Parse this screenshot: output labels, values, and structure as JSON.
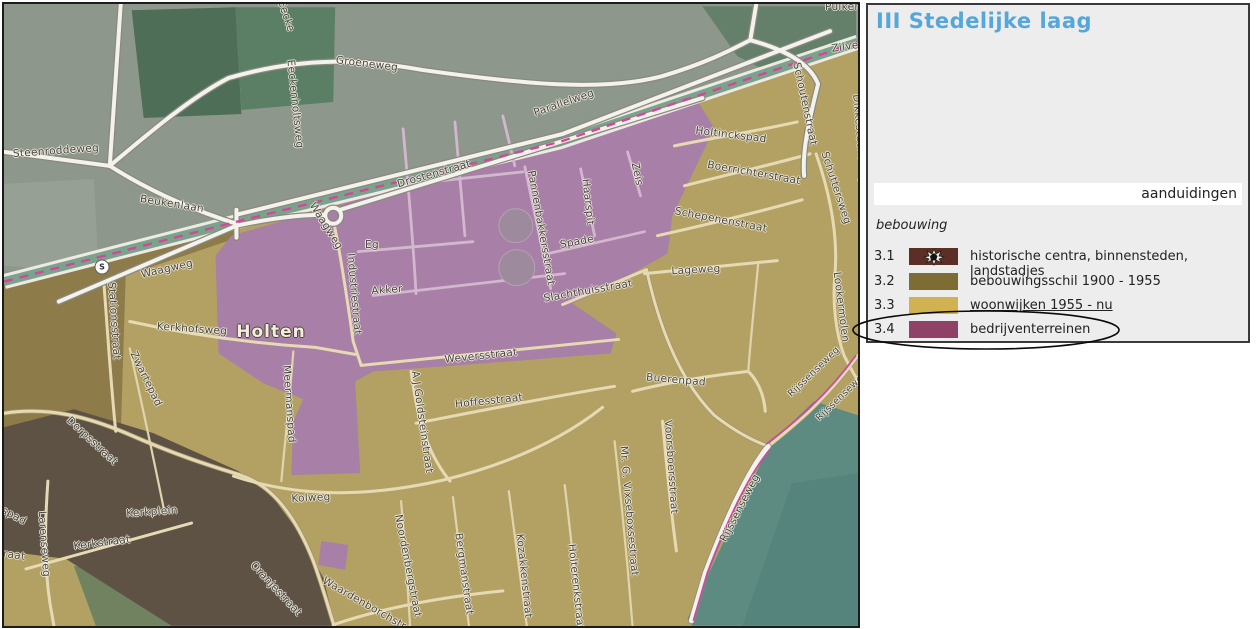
{
  "legend": {
    "title": "III Stedelijke laag",
    "tab": "aanduidingen",
    "section": "bebouwing",
    "rows": [
      {
        "code": "3.1",
        "label": "historische centra, binnensteden, landstadjes",
        "color": "#5c2f26",
        "icon": "historic-splat"
      },
      {
        "code": "3.2",
        "label": "bebouwingsschil 1900 - 1955",
        "color": "#7d6c33"
      },
      {
        "code": "3.3",
        "label": "woonwijken 1955 - nu",
        "color": "#d1b253",
        "underline": true
      },
      {
        "code": "3.4",
        "label": "bedrijventerreinen",
        "color": "#8f4166",
        "circled": true
      }
    ]
  },
  "colors": {
    "title": "#54a7d8",
    "panel_bg": "#ededed",
    "panel_border": "#3a3a3a",
    "map_border": "#1c1c1c",
    "purple": "#a87fa6",
    "tan": "#b3a164",
    "olive": "#8d7c4a",
    "historic": "#5d5244",
    "teal": "#5d8a81",
    "farmland": "#8e978b",
    "railway_magenta": "#d6449b",
    "road_white": "#f4f2ec",
    "label_text": "#44443e"
  },
  "map": {
    "town": "Holten",
    "station_symbol": "S",
    "street_labels": [
      {
        "text": "Steenroddeweg",
        "x": 52,
        "y": 147,
        "rot": -4
      },
      {
        "text": "Beukenlaan",
        "x": 168,
        "y": 200,
        "rot": 9
      },
      {
        "text": "Groeneweg",
        "x": 363,
        "y": 60,
        "rot": 7
      },
      {
        "text": "Eecke",
        "x": 282,
        "y": 12,
        "rot": 72,
        "cls": "partial"
      },
      {
        "text": "Eeckenholtsweg",
        "x": 291,
        "y": 100,
        "rot": 84
      },
      {
        "text": "Parallelweg",
        "x": 560,
        "y": 99,
        "rot": -19
      },
      {
        "text": "Drostenstraat",
        "x": 430,
        "y": 170,
        "rot": -16
      },
      {
        "text": "Waagweg",
        "x": 163,
        "y": 265,
        "rot": -13
      },
      {
        "text": "Waagweg",
        "x": 322,
        "y": 222,
        "rot": 58
      },
      {
        "text": "Stationsstraat",
        "x": 110,
        "y": 317,
        "rot": 86
      },
      {
        "text": "Kerkhofsweg",
        "x": 188,
        "y": 325,
        "rot": 4
      },
      {
        "text": "Holten",
        "x": 267,
        "y": 328,
        "rot": 0,
        "cls": "town"
      },
      {
        "text": "Zwartepad",
        "x": 142,
        "y": 375,
        "rot": 64
      },
      {
        "text": "Meermanspad",
        "x": 285,
        "y": 400,
        "rot": 86
      },
      {
        "text": "Industriestraat",
        "x": 350,
        "y": 290,
        "rot": 85
      },
      {
        "text": "Eg",
        "x": 368,
        "y": 241,
        "rot": 0
      },
      {
        "text": "Akker",
        "x": 383,
        "y": 286,
        "rot": -4
      },
      {
        "text": "Pannenbakkersstraat",
        "x": 537,
        "y": 224,
        "rot": 80
      },
      {
        "text": "Haarspit",
        "x": 584,
        "y": 198,
        "rot": 84
      },
      {
        "text": "Zeis",
        "x": 633,
        "y": 170,
        "rot": 78
      },
      {
        "text": "Spade",
        "x": 573,
        "y": 238,
        "rot": -10
      },
      {
        "text": "Slachthuisstraat",
        "x": 584,
        "y": 287,
        "rot": -10
      },
      {
        "text": "Weversstraat",
        "x": 477,
        "y": 352,
        "rot": -6
      },
      {
        "text": "Kolweg",
        "x": 307,
        "y": 494,
        "rot": -3
      },
      {
        "text": "A.J.Goldsteinstraat",
        "x": 418,
        "y": 418,
        "rot": 82
      },
      {
        "text": "Hoffesstraat",
        "x": 485,
        "y": 397,
        "rot": -6
      },
      {
        "text": "Boerrichterstraat",
        "x": 750,
        "y": 169,
        "rot": 10
      },
      {
        "text": "Schepenenstraat",
        "x": 717,
        "y": 216,
        "rot": 11
      },
      {
        "text": "Lageweg",
        "x": 692,
        "y": 266,
        "rot": -3
      },
      {
        "text": "Holtinckspad",
        "x": 727,
        "y": 131,
        "rot": 7
      },
      {
        "text": "Schoutenstraat",
        "x": 801,
        "y": 100,
        "rot": 78
      },
      {
        "text": "Dikkesteensweg",
        "x": 856,
        "y": 135,
        "rot": 85,
        "cls": "partial"
      },
      {
        "text": "Schuttersweg",
        "x": 832,
        "y": 184,
        "rot": 72
      },
      {
        "text": "Lookermolen",
        "x": 837,
        "y": 303,
        "rot": 83
      },
      {
        "text": "Buerenpad",
        "x": 672,
        "y": 376,
        "rot": 5
      },
      {
        "text": "Voorsboersstraat",
        "x": 667,
        "y": 463,
        "rot": 86
      },
      {
        "text": "Rijssenseweg",
        "x": 736,
        "y": 504,
        "rot": -63
      },
      {
        "text": "Rijssenseweg",
        "x": 810,
        "y": 368,
        "rot": -44,
        "size": 9.5
      },
      {
        "text": "Rijssenseweg",
        "x": 838,
        "y": 392,
        "rot": -44,
        "size": 9.5,
        "cls": "partial"
      },
      {
        "text": "Mr. G. Vixseboxsestraat",
        "x": 625,
        "y": 507,
        "rot": 85
      },
      {
        "text": "Holterenkstraat",
        "x": 572,
        "y": 583,
        "rot": 84
      },
      {
        "text": "Kozakkenstraat",
        "x": 520,
        "y": 572,
        "rot": 84
      },
      {
        "text": "Bergmanstraat",
        "x": 460,
        "y": 570,
        "rot": 82
      },
      {
        "text": "Noordenbergstraat",
        "x": 404,
        "y": 562,
        "rot": 79
      },
      {
        "text": "Waardenborchstraat",
        "x": 368,
        "y": 604,
        "rot": 30,
        "cls": "partial"
      },
      {
        "text": "Dorpsstraat",
        "x": 88,
        "y": 437,
        "rot": 43
      },
      {
        "text": "Kerkplein",
        "x": 148,
        "y": 508,
        "rot": -4
      },
      {
        "text": "Kerkstraat",
        "x": 98,
        "y": 539,
        "rot": -7
      },
      {
        "text": "Larenseweg",
        "x": 40,
        "y": 540,
        "rot": 86
      },
      {
        "text": "spad",
        "x": 10,
        "y": 512,
        "rot": 28,
        "cls": "partial"
      },
      {
        "text": "traat",
        "x": 8,
        "y": 551,
        "rot": 8,
        "cls": "partial"
      },
      {
        "text": "Oranjestraat",
        "x": 272,
        "y": 585,
        "rot": 47
      },
      {
        "text": "Zilve",
        "x": 841,
        "y": 43,
        "rot": -8,
        "cls": "partial"
      },
      {
        "text": "Pulker",
        "x": 838,
        "y": 3,
        "rot": 0,
        "cls": "partial"
      }
    ]
  }
}
